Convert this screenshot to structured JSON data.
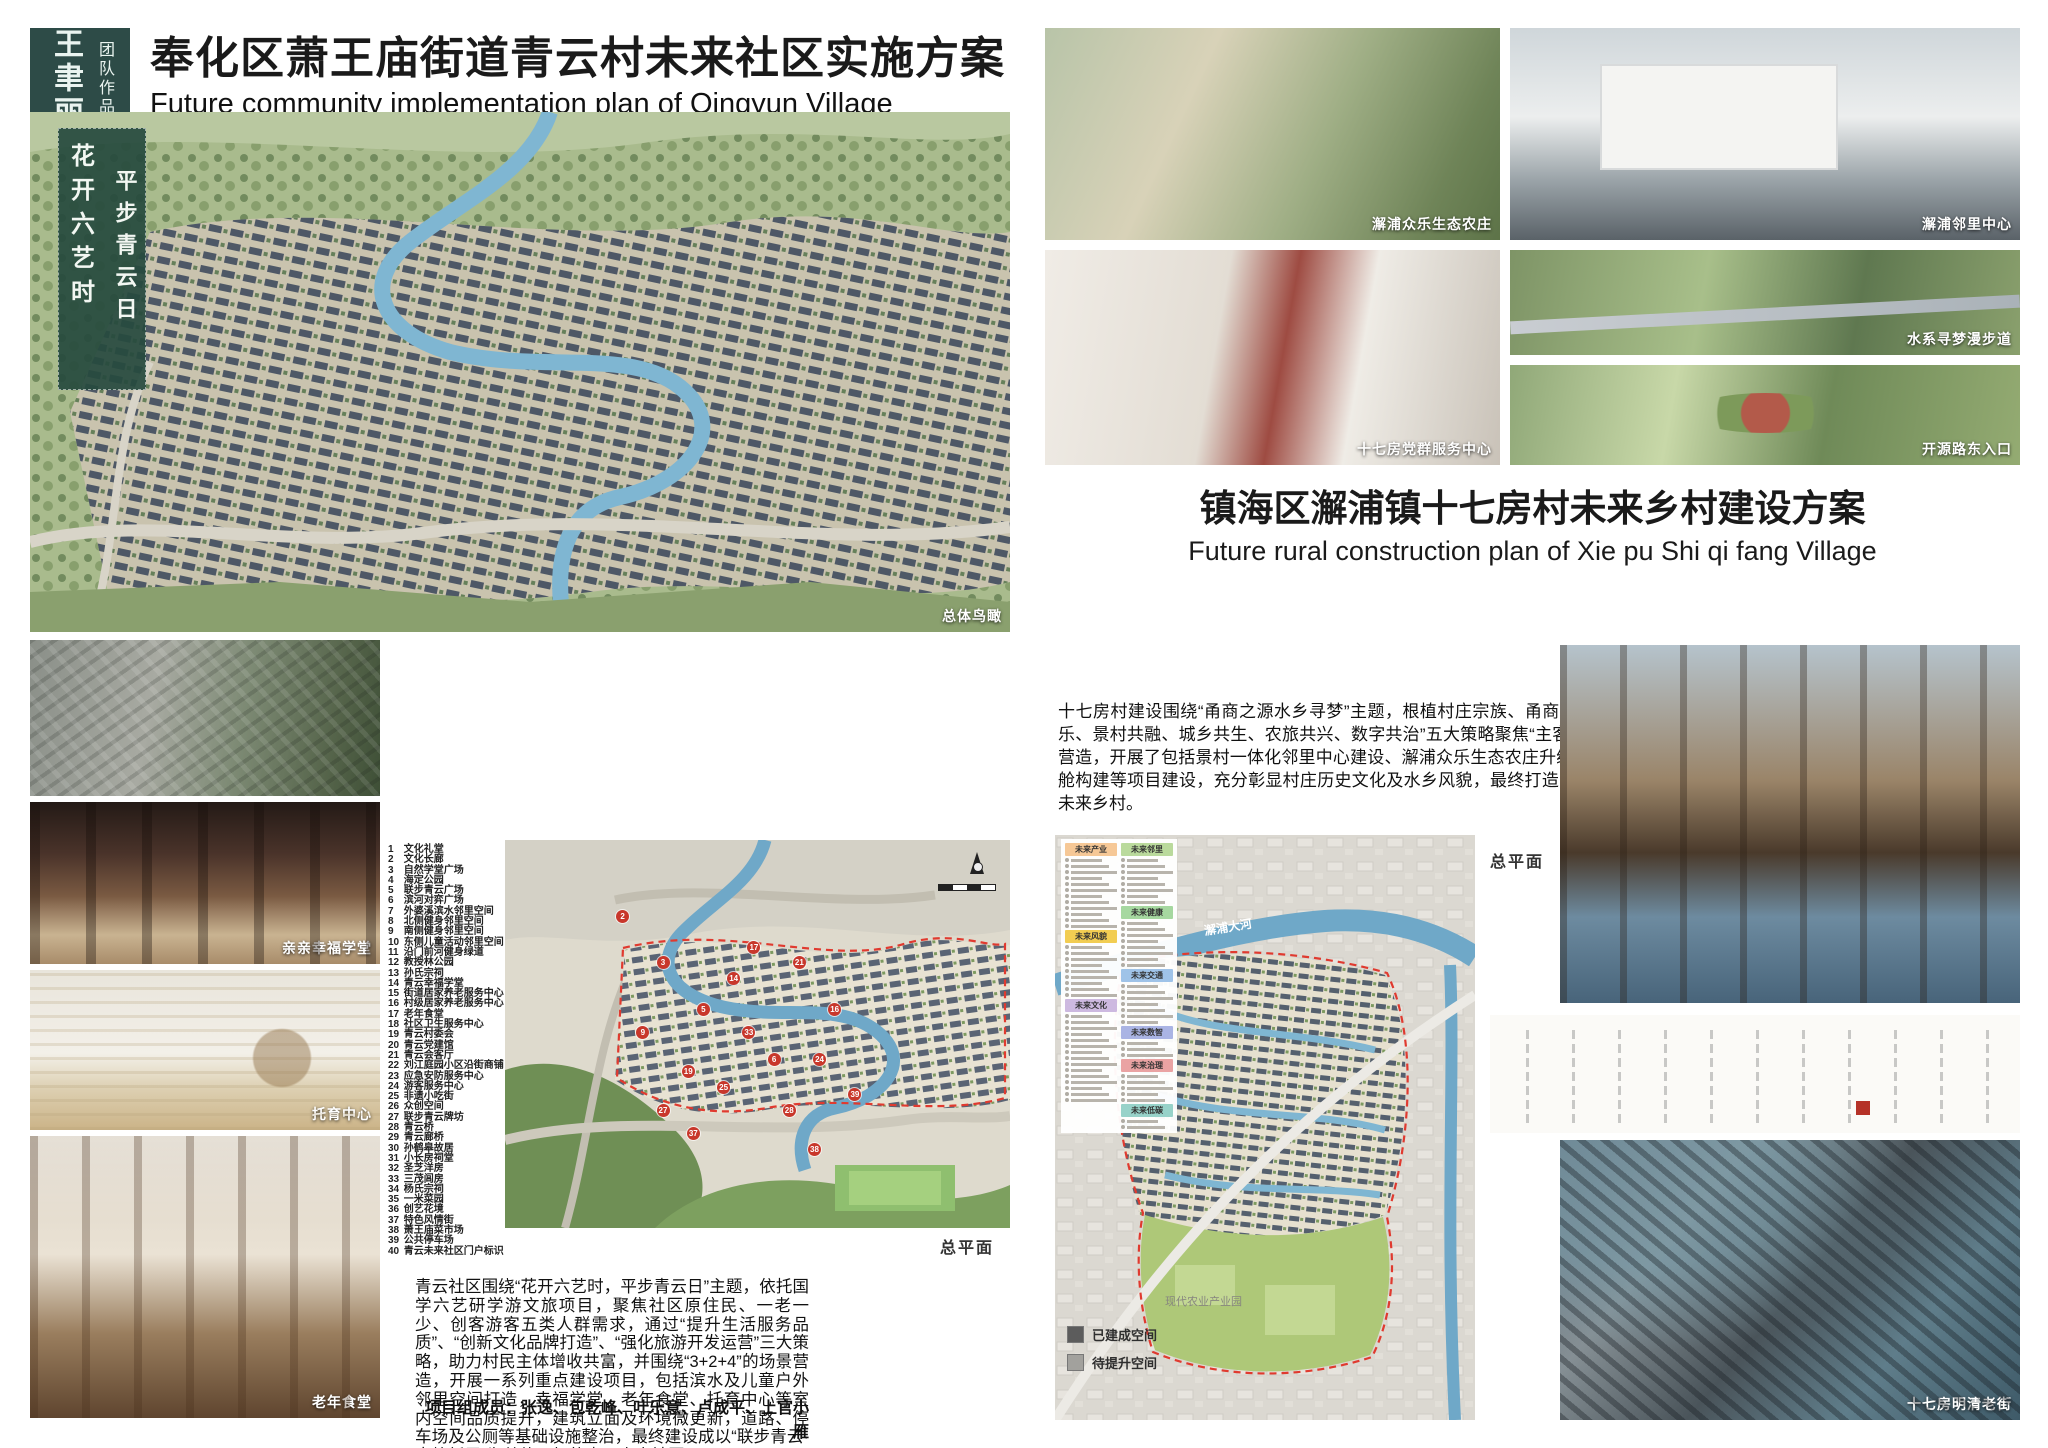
{
  "logo": {
    "name": "王聿丽",
    "subtitle": "团队作品"
  },
  "left": {
    "title": "奉化区萧王庙街道青云村未来社区实施方案",
    "subtitle": "Future community implementation plan of Qingyun Village",
    "calligraphy": [
      "花开六艺时",
      "平步青云日"
    ],
    "render_caption": "总体鸟瞰",
    "map_caption": "总平面",
    "photos": [
      {
        "caption": "亲亲幸福学堂"
      },
      {
        "caption": "托育中心"
      },
      {
        "caption": "老年食堂"
      }
    ],
    "legend": [
      {
        "n": 1,
        "label": "文化礼堂"
      },
      {
        "n": 2,
        "label": "文化长廊"
      },
      {
        "n": 3,
        "label": "自然学堂广场"
      },
      {
        "n": 4,
        "label": "海定公园"
      },
      {
        "n": 5,
        "label": "联步青云广场"
      },
      {
        "n": 6,
        "label": "滨河对弈广场"
      },
      {
        "n": 7,
        "label": "外婆溪滨水邻里空间"
      },
      {
        "n": 8,
        "label": "北侧健身邻里空间"
      },
      {
        "n": 9,
        "label": "南侧健身邻里空间"
      },
      {
        "n": 10,
        "label": "东侧儿童活动邻里空间"
      },
      {
        "n": 11,
        "label": "沿门前河健身绿道"
      },
      {
        "n": 12,
        "label": "教授林公园"
      },
      {
        "n": 13,
        "label": "孙氏宗祠"
      },
      {
        "n": 14,
        "label": "青云幸福学堂"
      },
      {
        "n": 15,
        "label": "街道居家养老服务中心"
      },
      {
        "n": 16,
        "label": "村级居家养老服务中心"
      },
      {
        "n": 17,
        "label": "老年食堂"
      },
      {
        "n": 18,
        "label": "社区卫生服务中心"
      },
      {
        "n": 19,
        "label": "青云村委会"
      },
      {
        "n": 20,
        "label": "青云党建馆"
      },
      {
        "n": 21,
        "label": "青云会客厅"
      },
      {
        "n": 22,
        "label": "刘江庭园小区沿街商铺"
      },
      {
        "n": 23,
        "label": "应急安防服务中心"
      },
      {
        "n": 24,
        "label": "游客服务中心"
      },
      {
        "n": 25,
        "label": "非遗小吃街"
      },
      {
        "n": 26,
        "label": "众创空间"
      },
      {
        "n": 27,
        "label": "联步青云牌坊"
      },
      {
        "n": 28,
        "label": "青云桥"
      },
      {
        "n": 29,
        "label": "青云廊桥"
      },
      {
        "n": 30,
        "label": "孙鹤皋故居"
      },
      {
        "n": 31,
        "label": "小长房祠堂"
      },
      {
        "n": 32,
        "label": "圣芝洋房"
      },
      {
        "n": 33,
        "label": "三茂闾房"
      },
      {
        "n": 34,
        "label": "杨氏宗祠"
      },
      {
        "n": 35,
        "label": "一米菜园"
      },
      {
        "n": 36,
        "label": "创艺花境"
      },
      {
        "n": 37,
        "label": "特色风情街"
      },
      {
        "n": 38,
        "label": "萧王庙菜市场"
      },
      {
        "n": 39,
        "label": "公共停车场"
      },
      {
        "n": 40,
        "label": "青云未来社区门户标识"
      }
    ],
    "map_markers": [
      {
        "n": 2,
        "x": 22,
        "y": 18
      },
      {
        "n": 3,
        "x": 30,
        "y": 30
      },
      {
        "n": 5,
        "x": 38,
        "y": 42
      },
      {
        "n": 6,
        "x": 52,
        "y": 55
      },
      {
        "n": 9,
        "x": 26,
        "y": 48
      },
      {
        "n": 14,
        "x": 44,
        "y": 34
      },
      {
        "n": 16,
        "x": 64,
        "y": 42
      },
      {
        "n": 17,
        "x": 48,
        "y": 26
      },
      {
        "n": 19,
        "x": 35,
        "y": 58
      },
      {
        "n": 21,
        "x": 57,
        "y": 30
      },
      {
        "n": 24,
        "x": 61,
        "y": 55
      },
      {
        "n": 25,
        "x": 42,
        "y": 62
      },
      {
        "n": 27,
        "x": 30,
        "y": 68
      },
      {
        "n": 28,
        "x": 55,
        "y": 68
      },
      {
        "n": 33,
        "x": 47,
        "y": 48
      },
      {
        "n": 37,
        "x": 36,
        "y": 74
      },
      {
        "n": 38,
        "x": 60,
        "y": 78
      },
      {
        "n": 39,
        "x": 68,
        "y": 64
      }
    ],
    "description": "青云社区围绕“花开六艺时，平步青云日”主题，依托国学六艺研学游文旅项目，聚焦社区原住民、一老一少、创客游客五类人群需求，通过“提升生活服务品质”、“创新文化品牌打造”、“强化旅游开发运营”三大策略，助力村民主体增收共富，并围绕“3+2+4”的场景营造，开展一系列重点建设项目，包括滨水及儿童户外邻里空间打造，幸福学堂、老年食堂、托育中心等室内空间品质提升，建筑立面及环境微更新，道路、停车场及公厕等基础设施整治，最终建设成以“联步青云·古韵新居”为总体目标的青云未来社区。",
    "members": "项目组成员：张逸、包乾峰、叶乐意、卢成平、上官小雁"
  },
  "right": {
    "title": "镇海区澥浦镇十七房村未来乡村建设方案",
    "subtitle": "Future rural construction plan of Xie pu Shi qi fang Village",
    "photos": [
      {
        "caption": "澥浦众乐生态农庄"
      },
      {
        "caption": "澥浦邻里中心"
      },
      {
        "caption": "十七房党群服务中心"
      },
      {
        "caption": "水系寻梦漫步道"
      },
      {
        "caption": "开源路东入口"
      }
    ],
    "description": "十七房村建设围绕“甬商之源水乡寻梦”主题，根植村庄宗族、甬商、女祠等特色文化，依托十七房开元景区优势，通过“全民共乐、景村共融、城乡共生、农旅共兴、数字共治”五大策略聚焦“主客共享·区域共富”的总体目标。同时，村庄围绕“3+4+2”的场景营造，开展了包括景村一体化邻里中心建设、澥浦众乐生态农庄升级、水乡寻梦游步道品质提升、儿童游戏场地改造、数字驾驶舱构建等项目建设，充分彰显村庄历史文化及水乡风貌，最终打造为以“农文旅融合江南古村、景村镇一体化共富水乡”为特色的未来乡村。",
    "members": "项目组成员：张逸、朱伟豪、叶乐意、刘成功、贝雯雯",
    "map_caption": "总平面",
    "map_labels": {
      "river": "澥浦大河",
      "industry_park": "现代农业产业园"
    },
    "legend_sections": [
      {
        "col": 1,
        "label": "未来产业",
        "color": "#f6c896",
        "items": 12
      },
      {
        "col": 1,
        "label": "未来风貌",
        "color": "#f2cd52",
        "items": 9
      },
      {
        "col": 1,
        "label": "未来文化",
        "color": "#cdb9e0",
        "items": 15
      },
      {
        "col": 2,
        "label": "未来邻里",
        "color": "#bada9c",
        "items": 8
      },
      {
        "col": 2,
        "label": "未来健康",
        "color": "#a6d8a0",
        "items": 8
      },
      {
        "col": 2,
        "label": "未来交通",
        "color": "#9fc3e8",
        "items": 7
      },
      {
        "col": 2,
        "label": "未来数智",
        "color": "#aab4e4",
        "items": 3
      },
      {
        "col": 2,
        "label": "未来治理",
        "color": "#eaa3a3",
        "items": 5
      },
      {
        "col": 2,
        "label": "未来低碳",
        "color": "#97d2c9",
        "items": 2
      }
    ],
    "status_legend": [
      {
        "label": "已建成空间",
        "color": "#5c5c5c"
      },
      {
        "label": "待提升空间",
        "color": "#a2a19d"
      }
    ],
    "bottom_caption": "十七房明清老街"
  }
}
